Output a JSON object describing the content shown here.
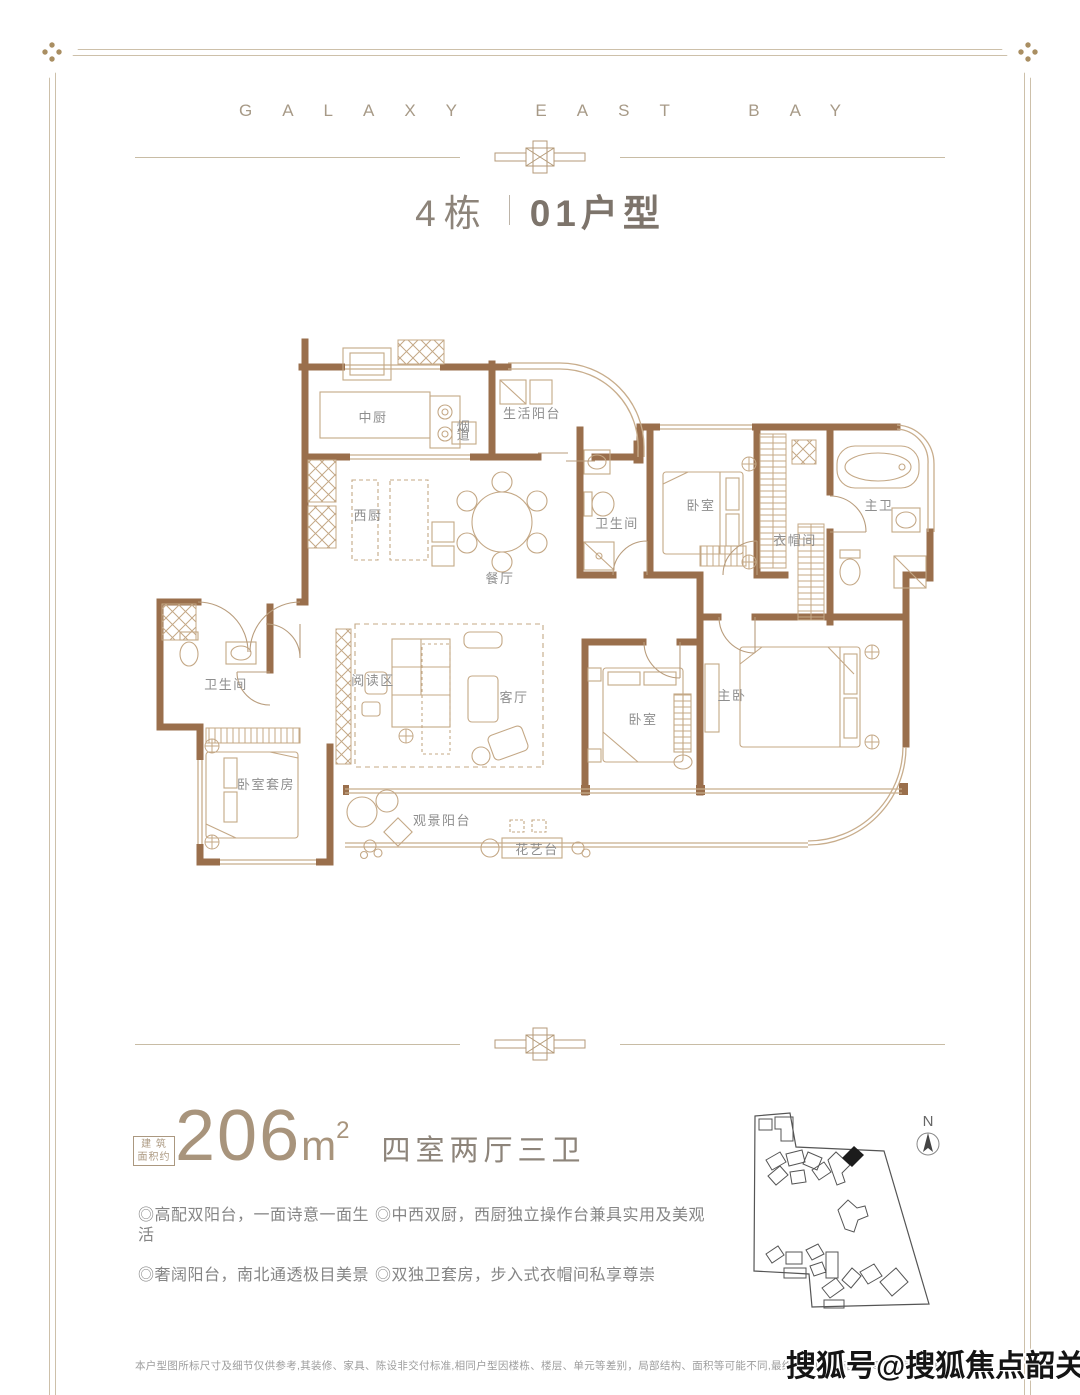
{
  "header": {
    "wordmark": "GALAXY EAST BAY"
  },
  "title": {
    "block": "4栋",
    "unit": "01户型"
  },
  "floorplan": {
    "rooms": [
      {
        "label": "中厨",
        "x": 233,
        "y": 90
      },
      {
        "label": "生活阳台",
        "x": 392,
        "y": 86
      },
      {
        "label": "烟道",
        "x": 324,
        "y": 99,
        "size": 7.5,
        "vertical": true
      },
      {
        "label": "西厨",
        "x": 228,
        "y": 188
      },
      {
        "label": "餐厅",
        "x": 360,
        "y": 251
      },
      {
        "label": "卫生间",
        "x": 477,
        "y": 196,
        "size": 11
      },
      {
        "label": "卧室",
        "x": 561,
        "y": 178
      },
      {
        "label": "衣帽间",
        "x": 655,
        "y": 213
      },
      {
        "label": "主卫",
        "x": 739,
        "y": 178
      },
      {
        "label": "卫生间",
        "x": 86,
        "y": 357,
        "size": 11
      },
      {
        "label": "阅读区",
        "x": 233,
        "y": 353
      },
      {
        "label": "客厅",
        "x": 374,
        "y": 370
      },
      {
        "label": "卧室套房",
        "x": 126,
        "y": 457
      },
      {
        "label": "卧室",
        "x": 503,
        "y": 392
      },
      {
        "label": "主卧",
        "x": 592,
        "y": 368
      },
      {
        "label": "观景阳台",
        "x": 302,
        "y": 493
      },
      {
        "label": "花艺台",
        "x": 397,
        "y": 522,
        "size": 11
      }
    ]
  },
  "area": {
    "label_line1": "建 筑",
    "label_line2": "面积约",
    "value": "206",
    "unit_base": "m",
    "unit_exp": "2",
    "layout": "四室两厅三卫"
  },
  "features": {
    "items": [
      "◎高配双阳台，一面诗意一面生活",
      "◎中西双厨，西厨独立操作台兼具实用及美观",
      "◎奢阔阳台，南北通透极目美景",
      "◎双独卫套房，步入式衣帽间私享尊崇"
    ]
  },
  "sitemap": {
    "north_label": "N"
  },
  "footer": {
    "disclaimer": "本户型图所标尺寸及细节仅供参考,其装修、家具、陈设非交付标准,相同户型因楼栋、楼层、单元等差别，局部结构、面积等可能不同,最终交付以《商品房买卖合同》及其补充协议约定为准。本户型图制作日期2021",
    "watermark": "搜狐号@搜狐焦点韶关站"
  },
  "colors": {
    "wall": "#9a6f4c",
    "furniture_line": "#c4a886",
    "window_line": "#c8ad8c",
    "frame": "#cdc0aa",
    "accent": "#a8947c",
    "label": "#8e8e8e"
  }
}
